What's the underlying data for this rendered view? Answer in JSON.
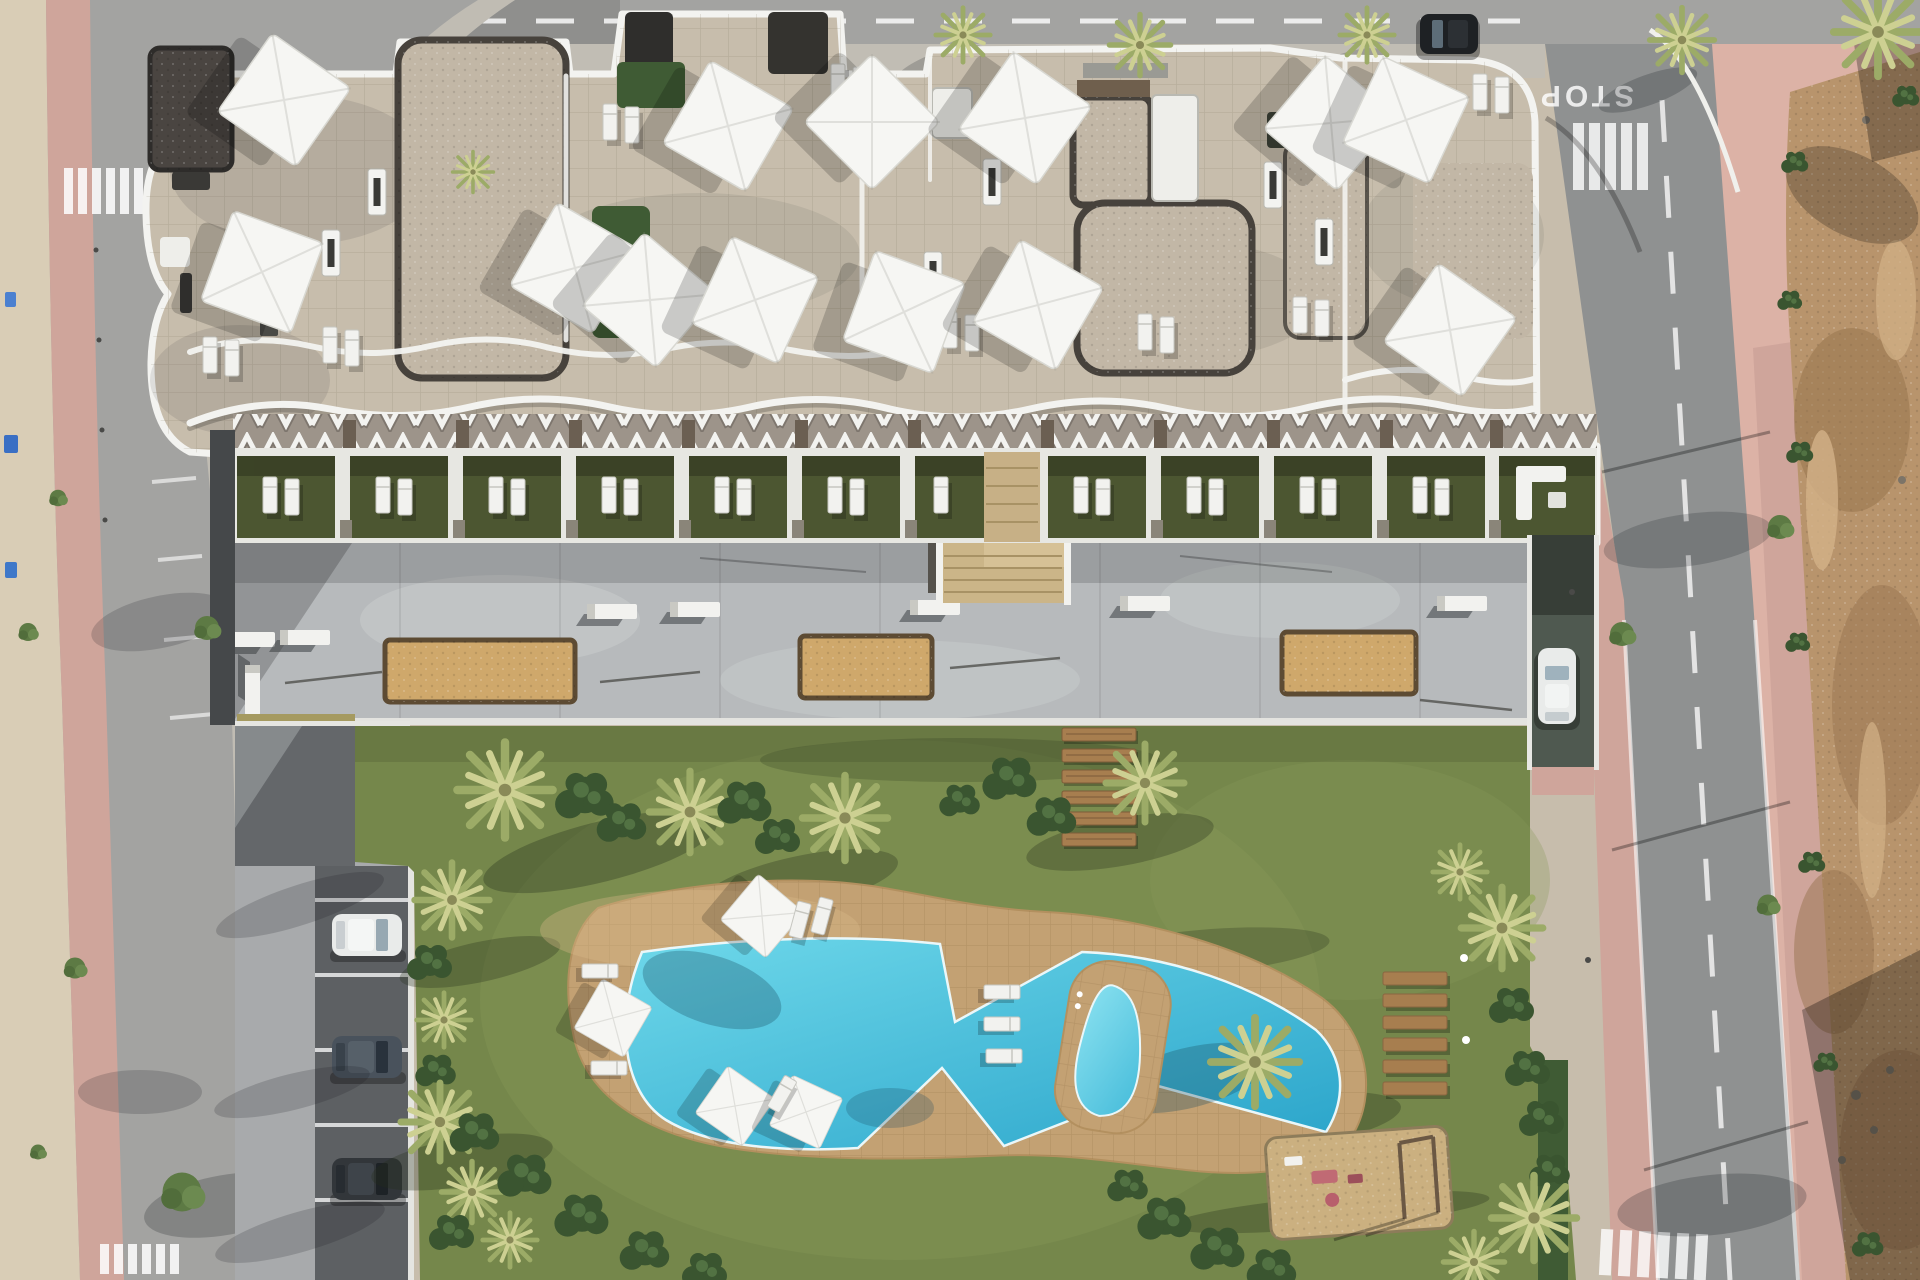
{
  "scene": {
    "type": "aerial-architectural-render",
    "description": "Top-down 3D render of a new-build apartment complex: white wavy-edged roof terraces with shade sails, ground-floor garden terraces, concrete plaza with petanque sand courts, large lawn with free-form swimming pool, kids pond, playground, parking lane with cars, surrounded by streets and an undeveloped dirt lot.",
    "road_markings": {
      "stop_text": "STOP"
    },
    "inventory": {
      "shade_sails": 13,
      "garden_terraces": 12,
      "sand_courts": 3,
      "pools": 2,
      "parked_cars": 3,
      "moving_cars": 2,
      "wooden_deck_steps": 6,
      "wooden_loungers": 6,
      "playgrounds": 1,
      "crosswalks": 3
    },
    "palette": {
      "asphalt": "#a3a3a1",
      "asphalt2": "#8f9191",
      "pink": "#cfa59b",
      "pinkplaza": "#dcb2a6",
      "sand": "#d9cdb6",
      "dirt": "#b8946c",
      "tile": "#c7bdac",
      "gravel": "#c2b7a6",
      "gravelborder": "#47423c",
      "white": "#f3f3f0",
      "concrete": "#b7babc",
      "terracelawn": "#4c5631",
      "lawn": "#75874b",
      "deck": "#c3a173",
      "water1": "#68d5e9",
      "water2": "#2aa4ca",
      "sandpit": "#cfa86b",
      "sandpitborder": "#5d4b33",
      "wood": "#a77e4f",
      "driveway": "#a8aaac",
      "parklane": "#5d6063",
      "hedge": "#3f5b34",
      "bush": "#3a5530",
      "palm1": "#cdd092",
      "palm2": "#9cab67",
      "car_white": "#e9ebea",
      "car_gray": "#49525c",
      "car_dark": "#32363a",
      "car_black": "#1e2124"
    }
  }
}
